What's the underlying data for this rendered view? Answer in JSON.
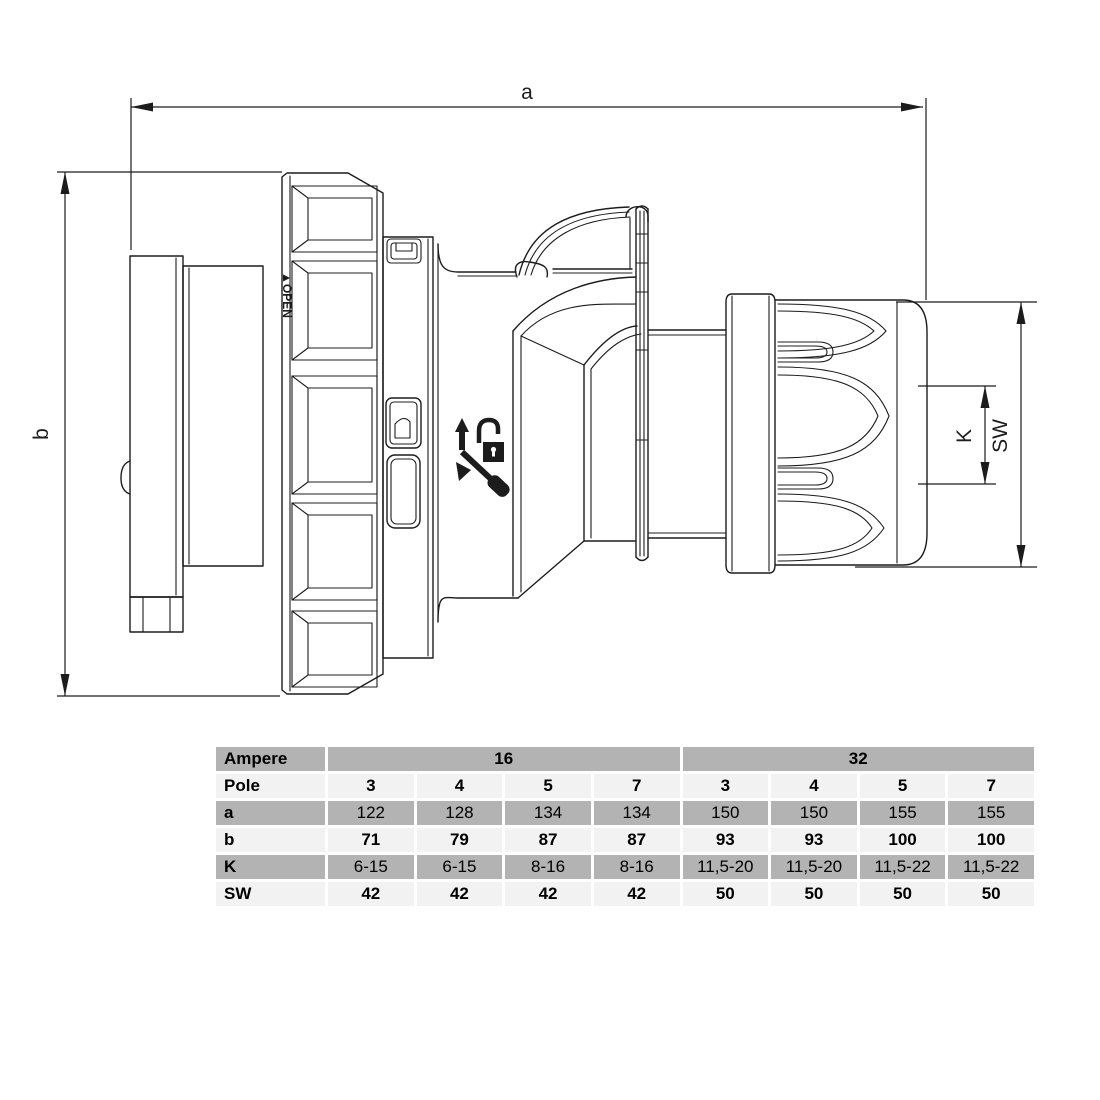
{
  "drawing": {
    "dim_a_label": "a",
    "dim_b_label": "b",
    "dim_k_label": "K",
    "dim_sw_label": "SW",
    "open_label": "▲OPEN",
    "line_color": "#1c1c1c"
  },
  "table": {
    "row_labels": [
      "Ampere",
      "Pole",
      "a",
      "b",
      "K",
      "SW"
    ],
    "ampere_groups": [
      {
        "label": "16",
        "span": 4
      },
      {
        "label": "32",
        "span": 4
      }
    ],
    "pole": [
      "3",
      "4",
      "5",
      "7",
      "3",
      "4",
      "5",
      "7"
    ],
    "a": [
      "122",
      "128",
      "134",
      "134",
      "150",
      "150",
      "155",
      "155"
    ],
    "b": [
      "71",
      "79",
      "87",
      "87",
      "93",
      "93",
      "100",
      "100"
    ],
    "k": [
      "6-15",
      "6-15",
      "8-16",
      "8-16",
      "11,5-20",
      "11,5-20",
      "11,5-22",
      "11,5-22"
    ],
    "sw": [
      "42",
      "42",
      "42",
      "42",
      "50",
      "50",
      "50",
      "50"
    ],
    "colors": {
      "dark_row": "#b3b3b3",
      "light_row": "#f2f2f2",
      "text": "#000000"
    }
  }
}
